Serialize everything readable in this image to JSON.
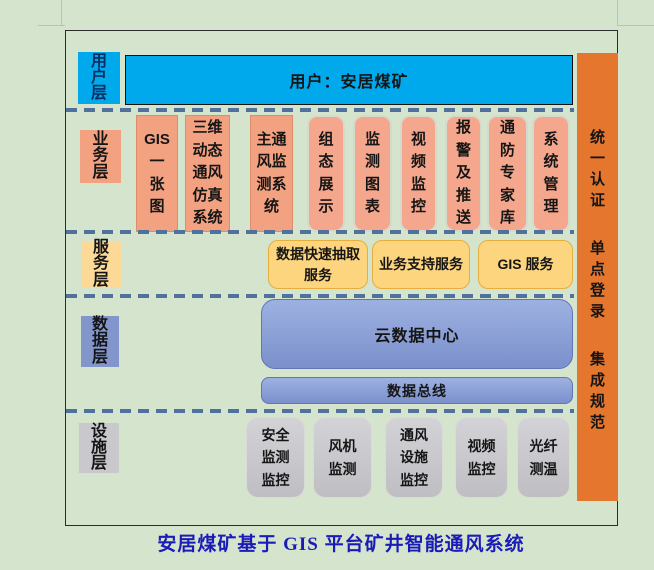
{
  "page": {
    "background": "#d5e4cc",
    "title": "安居煤矿基于 GIS 平台矿井智能通风系统"
  },
  "layers": {
    "user": {
      "label": "用\n户\n层",
      "box": "用户：安居煤矿"
    },
    "business": {
      "label": "业\n务\n层",
      "items": [
        "GIS\n一\n张\n图",
        "三维\n动态\n通风\n仿真\n系统",
        "主通\n风监\n测系\n统",
        "组\n态\n展\n示",
        "监\n测\n图\n表",
        "视\n频\n监\n控",
        "报\n警\n及\n推\n送",
        "通\n防\n专\n家\n库",
        "系\n统\n管\n理"
      ]
    },
    "service": {
      "label": "服\n务\n层",
      "items": [
        "数据快速抽取\n服务",
        "业务支持服务",
        "GIS 服务"
      ]
    },
    "data": {
      "label": "数\n据\n层",
      "items": [
        "云数据中心",
        "数据总线"
      ]
    },
    "facility": {
      "label": "设\n施\n层",
      "items": [
        "安全\n监测\n监控",
        "风机\n监测",
        "通风\n设施\n监控",
        "视频\n监控",
        "光纤\n测温"
      ]
    }
  },
  "sidebar": {
    "items": [
      "统\n一\n认\n证",
      "单\n点\n登\n录",
      "集\n成\n规\n范"
    ]
  },
  "colors": {
    "accent_cyan": "#00a9ec",
    "accent_salmon": "#f2a181",
    "accent_yellow": "#fdd57e",
    "accent_blue": "#8ba0d6",
    "accent_gray": "#c9c8cc",
    "accent_orange": "#e5762d",
    "dash_blue": "#4f719c",
    "title_blue": "#1b1bb8"
  }
}
